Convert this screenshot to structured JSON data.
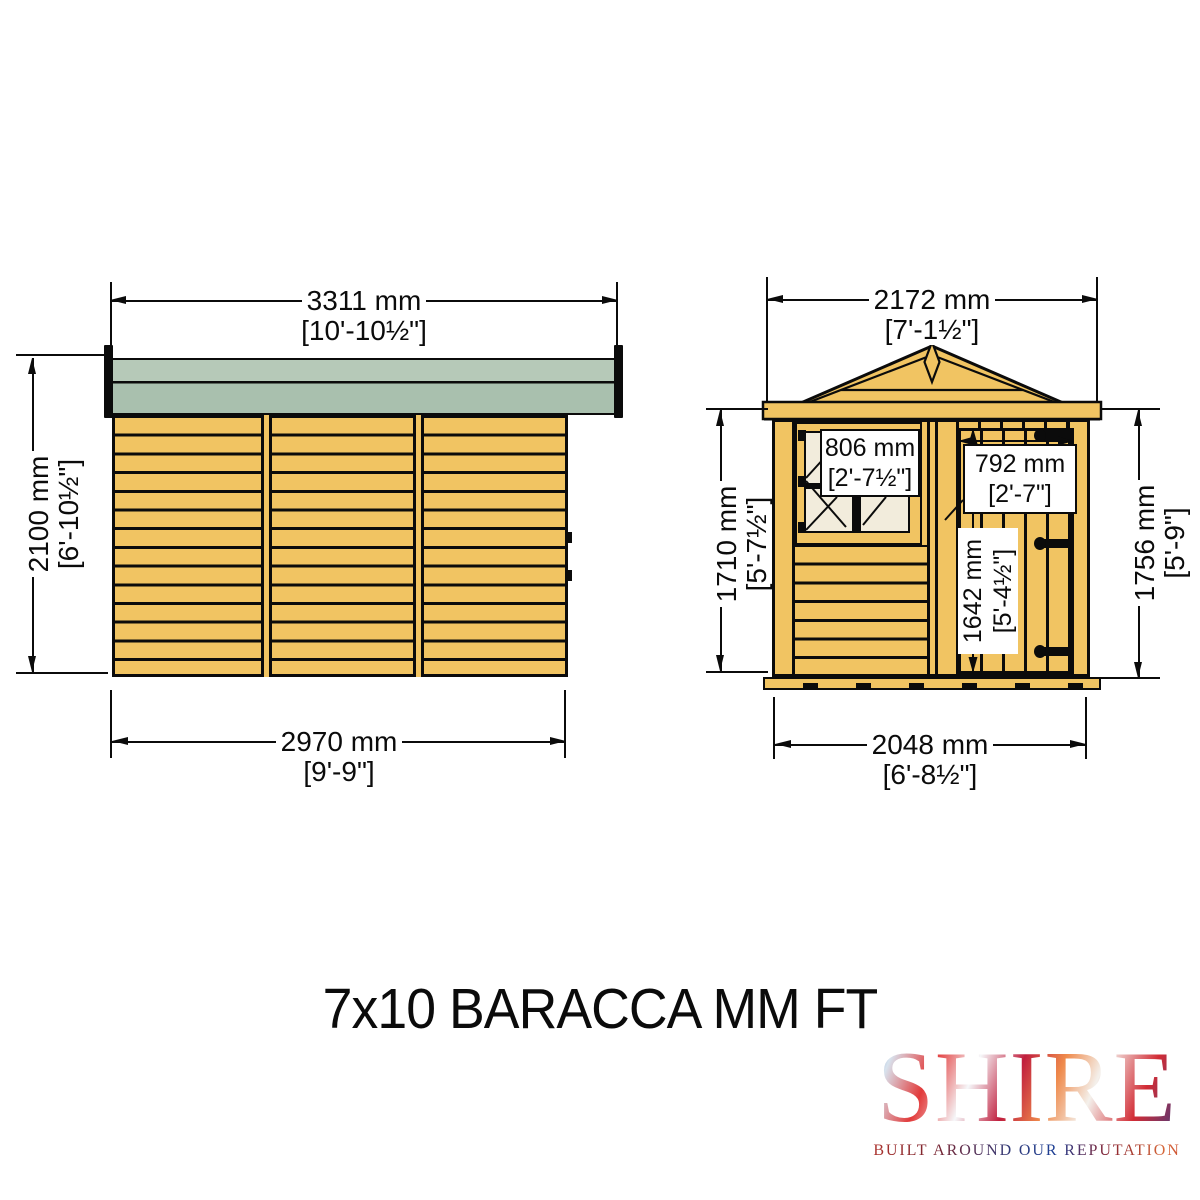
{
  "title": "7x10 BARACCA MM FT",
  "views": {
    "side": {
      "dims": {
        "roof_width": {
          "mm": "3311 mm",
          "ft": "[10'-10½\"]"
        },
        "height": {
          "mm": "2100 mm",
          "ft": "[6'-10½\"]"
        },
        "wall_width": {
          "mm": "2970 mm",
          "ft": "[9'-9\"]"
        }
      }
    },
    "front": {
      "dims": {
        "roof_width": {
          "mm": "2172 mm",
          "ft": "[7'-1½\"]"
        },
        "eaves_height_left": {
          "mm": "1710 mm",
          "ft": "[5'-7½\"]"
        },
        "eaves_height_right": {
          "mm": "1756 mm",
          "ft": "[5'-9\"]"
        },
        "window_width": {
          "mm": "806 mm",
          "ft": "[2'-7½\"]"
        },
        "door_width": {
          "mm": "792 mm",
          "ft": "[2'-7\"]"
        },
        "door_height": {
          "mm": "1642 mm",
          "ft": "[5'-4½\"]"
        },
        "base_width": {
          "mm": "2048 mm",
          "ft": "[6'-8½\"]"
        }
      }
    }
  },
  "logo": {
    "brand": "SHIRE",
    "tagline": "BUILT AROUND OUR REPUTATION"
  },
  "colors": {
    "wood": "#f1c462",
    "roof-top": "#b6c9b8",
    "roof-mid": "#a9c0ae",
    "cream": "#f2ecdc",
    "ink": "#0b0b0b"
  }
}
